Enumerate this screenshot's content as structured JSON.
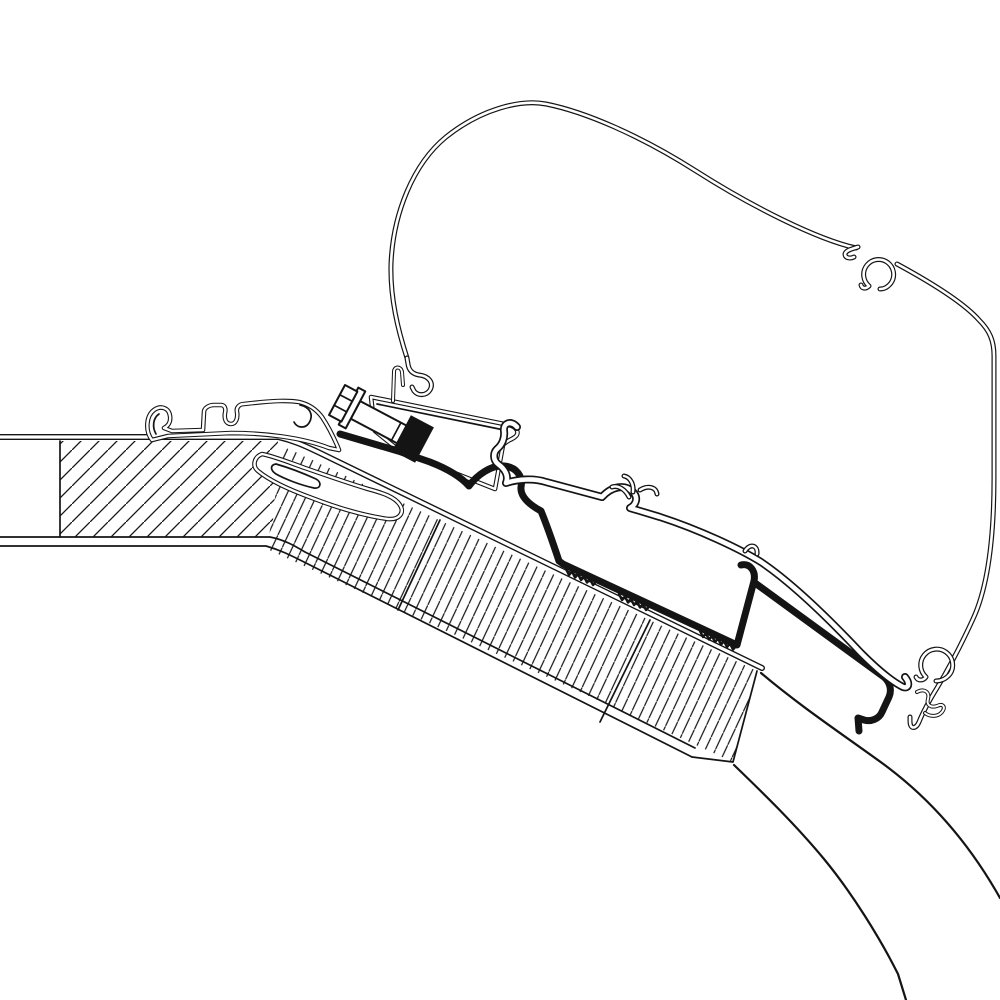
{
  "meta": {
    "description": "Technical line drawing: awning roof-adapter cross-section mounted between a hatched caravan roof panel and an awning case profile",
    "visible_text": []
  },
  "canvas": {
    "w": 1000,
    "h": 1000
  },
  "colors": {
    "line": "#141414",
    "white": "#ffffff",
    "background": "#ffffff"
  },
  "hatches": [
    {
      "id": "hatch45",
      "size": 18,
      "rotate": 0,
      "stroke": 1.3
    },
    {
      "id": "hatchBand",
      "size": 13,
      "rotate": -20,
      "stroke": 1.2
    }
  ],
  "styles": {
    "single": [
      {
        "s": "line",
        "w": 1.7
      }
    ],
    "single2": [
      {
        "s": "line",
        "w": 2.2
      }
    ],
    "edge": [
      {
        "s": "line",
        "w": 6
      },
      {
        "s": "#ffffff",
        "w": 3.2
      }
    ],
    "case": [
      {
        "s": "line",
        "w": 5
      },
      {
        "s": "#ffffff",
        "w": 2.6
      }
    ],
    "thin": [
      {
        "s": "line",
        "w": 4
      },
      {
        "s": "#ffffff",
        "w": 2
      }
    ],
    "thinfill": [
      {
        "s": "line",
        "w": 4.6,
        "f": "#ffffff"
      },
      {
        "s": "#ffffff",
        "w": 2.4
      }
    ],
    "tube": [
      {
        "s": "line",
        "w": 8
      },
      {
        "s": "#ffffff",
        "w": 4.6
      }
    ],
    "tubethin": [
      {
        "s": "line",
        "w": 5
      },
      {
        "s": "#ffffff",
        "w": 2.4
      }
    ],
    "thick": [
      {
        "s": "line",
        "w": 7
      }
    ],
    "teeth": [
      {
        "s": "line",
        "w": 2.5
      }
    ],
    "outline2": [
      {
        "s": "line",
        "w": 2,
        "f": "#ffffff"
      }
    ],
    "fillonly": [
      {}
    ]
  },
  "parts": [
    {
      "name": "roof-panel-hatch",
      "shape": "polygon",
      "style": "fillonly",
      "fill": "hatch45",
      "points": "60,441 278,441 272,537 60,537"
    },
    {
      "name": "roof-band-hatch",
      "shape": "polygon",
      "style": "fillonly",
      "fill": "hatchBand",
      "points": "283,446 757,671 733,762 267,549"
    },
    {
      "name": "roof-band-joint-line-1",
      "shape": "path",
      "style": "single",
      "d": "M 440 520 L 398 610"
    },
    {
      "name": "roof-band-joint-line-2",
      "shape": "path",
      "style": "single",
      "d": "M 650 620 L 600 722"
    },
    {
      "name": "roof-top-edge",
      "shape": "path",
      "style": "edge",
      "d": "M 0 437 L 278 437 C 295 441 305 446 318 452 L 762 668"
    },
    {
      "name": "roof-bottom-edge-outer",
      "shape": "path",
      "style": "single",
      "d": "M 0 537 L 270 537 C 285 540 295 546 305 552 L 695 748"
    },
    {
      "name": "roof-bottom-edge-inner",
      "shape": "path",
      "style": "single",
      "d": "M 0 546 L 266 546 C 280 550 290 555 300 560 L 692 757"
    },
    {
      "name": "roof-panel-left-divider",
      "shape": "path",
      "style": "single",
      "d": "M 60 441 L 60 537"
    },
    {
      "name": "roof-band-end-face",
      "shape": "path",
      "style": "single",
      "d": "M 757 671 L 733 762 L 692 757"
    },
    {
      "name": "vehicle-wall-curve-upper",
      "shape": "path",
      "style": "single2",
      "d": "M 761 673 C 800 706 842 734 882 763 C 930 798 968 843 996 891 L 1000 898"
    },
    {
      "name": "vehicle-wall-curve-lower",
      "shape": "path",
      "style": "single2",
      "d": "M 734 765 C 762 792 795 824 824 859 C 852 893 880 938 898 974 L 906 1000"
    },
    {
      "name": "roof-rail-profile",
      "shape": "path",
      "style": "thinfill",
      "d": "M 152 440 C 145 431 146 416 154 410 C 161 405 169 408 170 416 C 171 422 168 426 164 428 L 172 431 L 203 430 L 204 412 C 204 408 209 405 214 405 L 221 405 C 225 405 226 409 225 413 C 224 419 226 424 231 424 C 236 424 238 418 237 412 C 236 408 239 404 244 404 L 253 403 C 272 401 287 400 299 402 C 308 404 316 409 322 417 C 328 426 333 436 337 445 L 339 450 L 329 448 C 301 437 262 433 231 433 L 168 436 Z"
    },
    {
      "name": "roof-rail-inner-curl-left",
      "shape": "path",
      "style": "single",
      "d": "M 156 434 C 152 427 153 418 159 414"
    },
    {
      "name": "roof-rail-end-curl",
      "shape": "path",
      "style": "single",
      "d": "M 300 405 C 310 407 314 415 309 423 C 305 429 297 428 294 422"
    },
    {
      "name": "roof-shoe-profile",
      "shape": "path",
      "style": "thinfill",
      "d": "M 262 454 C 254 457 252 466 258 471 C 270 481 290 490 312 498 C 338 508 366 516 388 519 C 399 520 405 513 400 505 C 395 497 383 493 368 489 C 348 483 325 475 305 468 C 288 462 273 456 262 454 Z"
    },
    {
      "name": "roof-shoe-inner-slot",
      "shape": "path",
      "style": "single",
      "d": "M 276 464 C 290 468 305 474 316 479 C 322 482 321 489 314 488 C 300 485 285 479 276 474 C 270 470 270 465 276 464 Z"
    },
    {
      "name": "awning-case-outline",
      "shape": "path",
      "style": "case",
      "d": "M 407 358 C 398 330 390 298 391 264 C 393 214 413 164 446 137 C 481 109 521 99 546 104 C 586 112 641 136 696 171 C 751 206 816 239 856 248"
    },
    {
      "name": "awning-case-left-hook",
      "shape": "path",
      "style": "case",
      "d": "M 407 358 L 408 364 C 409 371 413 374 419 375 C 429 376 434 383 430 390 C 426 396 418 396 414 391 L 412 387"
    },
    {
      "name": "awning-case-upper-tab",
      "shape": "path",
      "style": "case",
      "d": "M 858 247 C 852 249 846 250 845 254 C 845 258 850 259 854 257"
    },
    {
      "name": "awning-case-upper-c-hook",
      "shape": "path",
      "style": "case",
      "d": "M 869 286 A 15 15 0 1 1 891 283 C 888 287 884 289 880 289 M 869 286 C 866 289 862 289 861 285"
    },
    {
      "name": "awning-case-right-outline",
      "shape": "path",
      "style": "case",
      "d": "M 897 264 C 932 283 964 303 979 320 C 990 331 994 341 994 356 L 994 478 C 994 540 987 589 973 619 C 962 643 949 668 937 688 C 929 701 923 712 919 722 C 916 729 910 730 910 721 L 910 717"
    },
    {
      "name": "awning-case-lower-c-loop",
      "shape": "path",
      "style": "case",
      "d": "M 926 677 A 16 16 0 1 1 950 674 C 946 679 941 681 936 681 M 926 677 C 923 681 918 681 916 677"
    },
    {
      "name": "awning-case-lower-fingers",
      "shape": "path",
      "style": "thin",
      "d": "M 917 692 C 924 688 930 692 928 699 C 926 705 931 708 937 706 C 943 703 946 707 942 712 C 938 717 930 717 925 713"
    },
    {
      "name": "mount-bracket-body",
      "shape": "path",
      "style": "thinfill",
      "d": "M 371 397 L 509 425 C 517 427 520 433 515 437 C 511 440 506 441 503 445 L 495 489 L 447 470 L 400 451 L 375 431 Z"
    },
    {
      "name": "mount-bracket-inner-line",
      "shape": "path",
      "style": "single",
      "d": "M 377 404 L 504 430"
    },
    {
      "name": "mount-bracket-tab",
      "shape": "path",
      "style": "thin",
      "d": "M 393 401 L 394 372 C 394 366 401 366 402 372 L 403 385"
    },
    {
      "name": "bolt-shaft",
      "shape": "polygon",
      "style": "outline2",
      "points": "360.2,401.1 420.3,432.9 410.9,450.6 350.8,418.7"
    },
    {
      "name": "bolt-thread-line-1",
      "shape": "path",
      "style": "single",
      "d": "M 392 439.4 L 400.4 423.6"
    },
    {
      "name": "bolt-thread-line-2",
      "shape": "path",
      "style": "single",
      "d": "M 398.1 442.6 L 406.5 426.8"
    },
    {
      "name": "bolt-thread-line-3",
      "shape": "path",
      "style": "single",
      "d": "M 404.3 445.9 L 412.7 430.1"
    },
    {
      "name": "bolt-washer",
      "shape": "polygon",
      "style": "outline2",
      "points": "358.3,387.6 365.3,391.4 345.7,428.4 338.7,424.6"
    },
    {
      "name": "bolt-hex-head",
      "shape": "polygon",
      "style": "outline2",
      "points": "345,385 357.4,391.6 341.4,421.6 329,415"
    },
    {
      "name": "bolt-head-facet-1",
      "shape": "path",
      "style": "single",
      "d": "M 334.2 405.3 L 346.6 411.9"
    },
    {
      "name": "bolt-head-facet-2",
      "shape": "path",
      "style": "single",
      "d": "M 339.8 394.7 L 352.2 401.3"
    },
    {
      "name": "adapter-profile-main",
      "shape": "path",
      "style": "thick",
      "d": "M 340 434 L 398 451 L 430 462 C 448 469 461 477 469 486 C 477 475 491 465 504 466 C 517 467 523 477 521 487 C 520 497 530 505 541 511 C 548 528 554 546 559 561 L 563 564 L 737 645 L 754 581 C 756 571 750 563 741 565"
    },
    {
      "name": "adapter-profile-right",
      "shape": "path",
      "style": "thick",
      "d": "M 755 583 L 884 677 C 890 682 892 690 889 697 L 882 712 C 879 719 871 722 864 720 L 858 718 L 859 731"
    },
    {
      "name": "adapter-serration-1",
      "shape": "path",
      "style": "teeth",
      "d": "M 566 569 l 3 6 l 3 -3.5 l 3 6 l 3 -3.5 l 3 6 l 3 -3.5 l 3 6 l 3 -3.5 l 3 6 l 3 -3.5"
    },
    {
      "name": "adapter-serration-2",
      "shape": "path",
      "style": "teeth",
      "d": "M 619 594 l 3 6 l 3 -3.5 l 3 6 l 3 -3.5 l 3 6 l 3 -3.5 l 3 6 l 3 -3.5 l 3 6 l 3 -3.5"
    },
    {
      "name": "adapter-serration-3",
      "shape": "path",
      "style": "teeth",
      "d": "M 700 631 l 3 6 l 3 -3.5 l 3 6 l 3 -3.5 l 3 6 l 3 -3.5 l 3 6 l 3 -3.5 l 3 6 l 3 -3.5 l 3 6 l 3 -3.5"
    },
    {
      "name": "clamp-nut-block",
      "shape": "polygon",
      "style": "fillonly",
      "fill": "black",
      "points": "410.9,415.2 433.9,427.4 415.1,462.8 392.1,450.6"
    },
    {
      "name": "lower-rail-profile",
      "shape": "path",
      "style": "tube",
      "d": "M 517 427 C 511 420 503 423 504 431 C 505 438 502 445 497 449 C 493 453 493 460 498 464 C 505 469 509 476 506 483 C 518 479 534 478 546 482 L 602 497 C 612 486 625 484 633 492 C 638 497 637 504 630 508 L 660 517 C 700 530 740 549 761 562 C 792 583 830 620 861 653 C 881 673 895 683 903 687 C 909 689 910 683 905 677"
    },
    {
      "name": "lower-rail-antler-1",
      "shape": "path",
      "style": "tubethin",
      "d": "M 629 497 C 625 489 618 485 612 487"
    },
    {
      "name": "lower-rail-antler-2",
      "shape": "path",
      "style": "tubethin",
      "d": "M 633 492 C 634 484 630 477 624 476"
    },
    {
      "name": "lower-rail-antler-3",
      "shape": "path",
      "style": "tubethin",
      "d": "M 640 490 C 648 485 656 487 657 494"
    },
    {
      "name": "lower-rail-notch",
      "shape": "path",
      "style": "tubethin",
      "d": "M 745 551 C 750 543 758 545 757 554"
    }
  ]
}
